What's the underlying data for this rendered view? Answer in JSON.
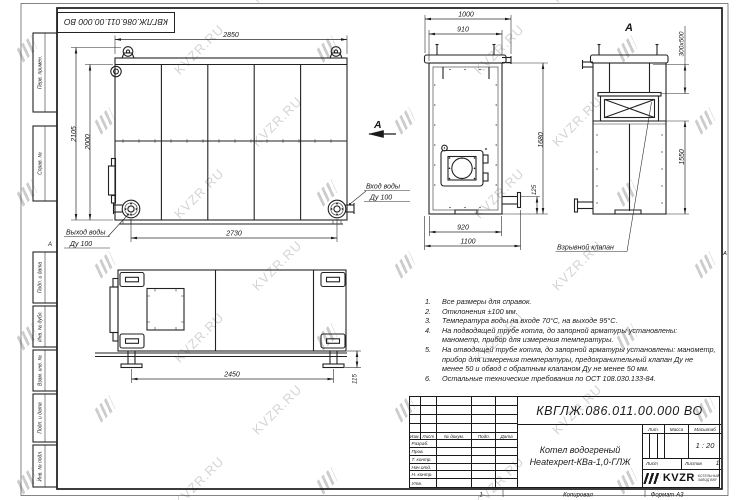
{
  "watermark": {
    "text": "KVZR.RU"
  },
  "top_stamp": {
    "doc_number": "КВГЛЖ.086.011.00.000 ВО"
  },
  "frame": {
    "left_labels": [
      "Перв. примен.",
      "Справ. №",
      "Подп. и дата",
      "Инв. № дубл.",
      "Взам. инв. №",
      "Подп. и дата",
      "Инв. № подл."
    ],
    "zone_marker_left": "А",
    "zone_marker_right": "А"
  },
  "front_view": {
    "dim_width_top": "2850",
    "dim_height_outer": "2105",
    "dim_height_inner": "2000",
    "dim_width_bottom": "2730",
    "inlet_label": "Вход воды",
    "inlet_size": "Ду 100",
    "outlet_label": "Выход воды",
    "outlet_size": "Ду 100",
    "section_label": "А"
  },
  "side_view": {
    "dim_width_overall": "1000",
    "dim_width_body": "910",
    "dim_height": "1680",
    "dim_pipe_offset": "125",
    "dim_bottom_body": "920",
    "dim_bottom_overall": "1100"
  },
  "back_view": {
    "view_label": "А",
    "dim_flue": "300х500",
    "dim_height": "1550",
    "callout_valve": "Взрывной клапан"
  },
  "bottom_view": {
    "dim_length": "2450",
    "dim_foot_height": "115"
  },
  "notes": [
    {
      "num": "1.",
      "text": "Все размеры для справок."
    },
    {
      "num": "2.",
      "text": "Отклонения ±100 мм."
    },
    {
      "num": "3.",
      "text": "Температура воды на входе 70°С, на выходе 95°С."
    },
    {
      "num": "4.",
      "text": "На подводящей трубе котла, до запорной арматуры установлены: манометр, прибор для измерения температуры."
    },
    {
      "num": "5.",
      "text": "На отводящей трубе котла, до запорной арматуры установлены: манометр, прибор для измерения температуры, предохранительный клапан Ду не менее 50 и обвод с обратным клапаном Ду не менее 50 мм."
    },
    {
      "num": "6.",
      "text": "Остальные технические требования по ОСТ 108.030.133-84."
    }
  ],
  "title_block": {
    "doc_number": "КВГЛЖ.086.011.00.000 ВО",
    "product_name_line1": "Котел водогреный",
    "product_name_line2": "Heatexpert-КВа-1,0-ГЛЖ",
    "col_izm": "Изм.",
    "col_list": "Лист",
    "col_doc": "№ докум.",
    "col_podp": "Подп.",
    "col_data": "Дата",
    "row_labels": [
      "Разраб.",
      "Пров.",
      "Т. контр.",
      "Нач.отд.",
      "Н. контр.",
      "Утв."
    ],
    "lit_label": "Лит.",
    "mass_label": "Масса",
    "scale_label": "Масштаб",
    "scale_value": "1 : 20",
    "sheet_label": "Лист",
    "sheets_label": "Листов",
    "sheets_value": "1",
    "logo_text": "KVZR",
    "logo_caption_line1": "КОТЕЛЬНЫЙ",
    "logo_caption_line2": "ЗАВОД ВВУ",
    "page_number": "1",
    "copied_label": "Копировал",
    "format_label": "Формат А3"
  }
}
